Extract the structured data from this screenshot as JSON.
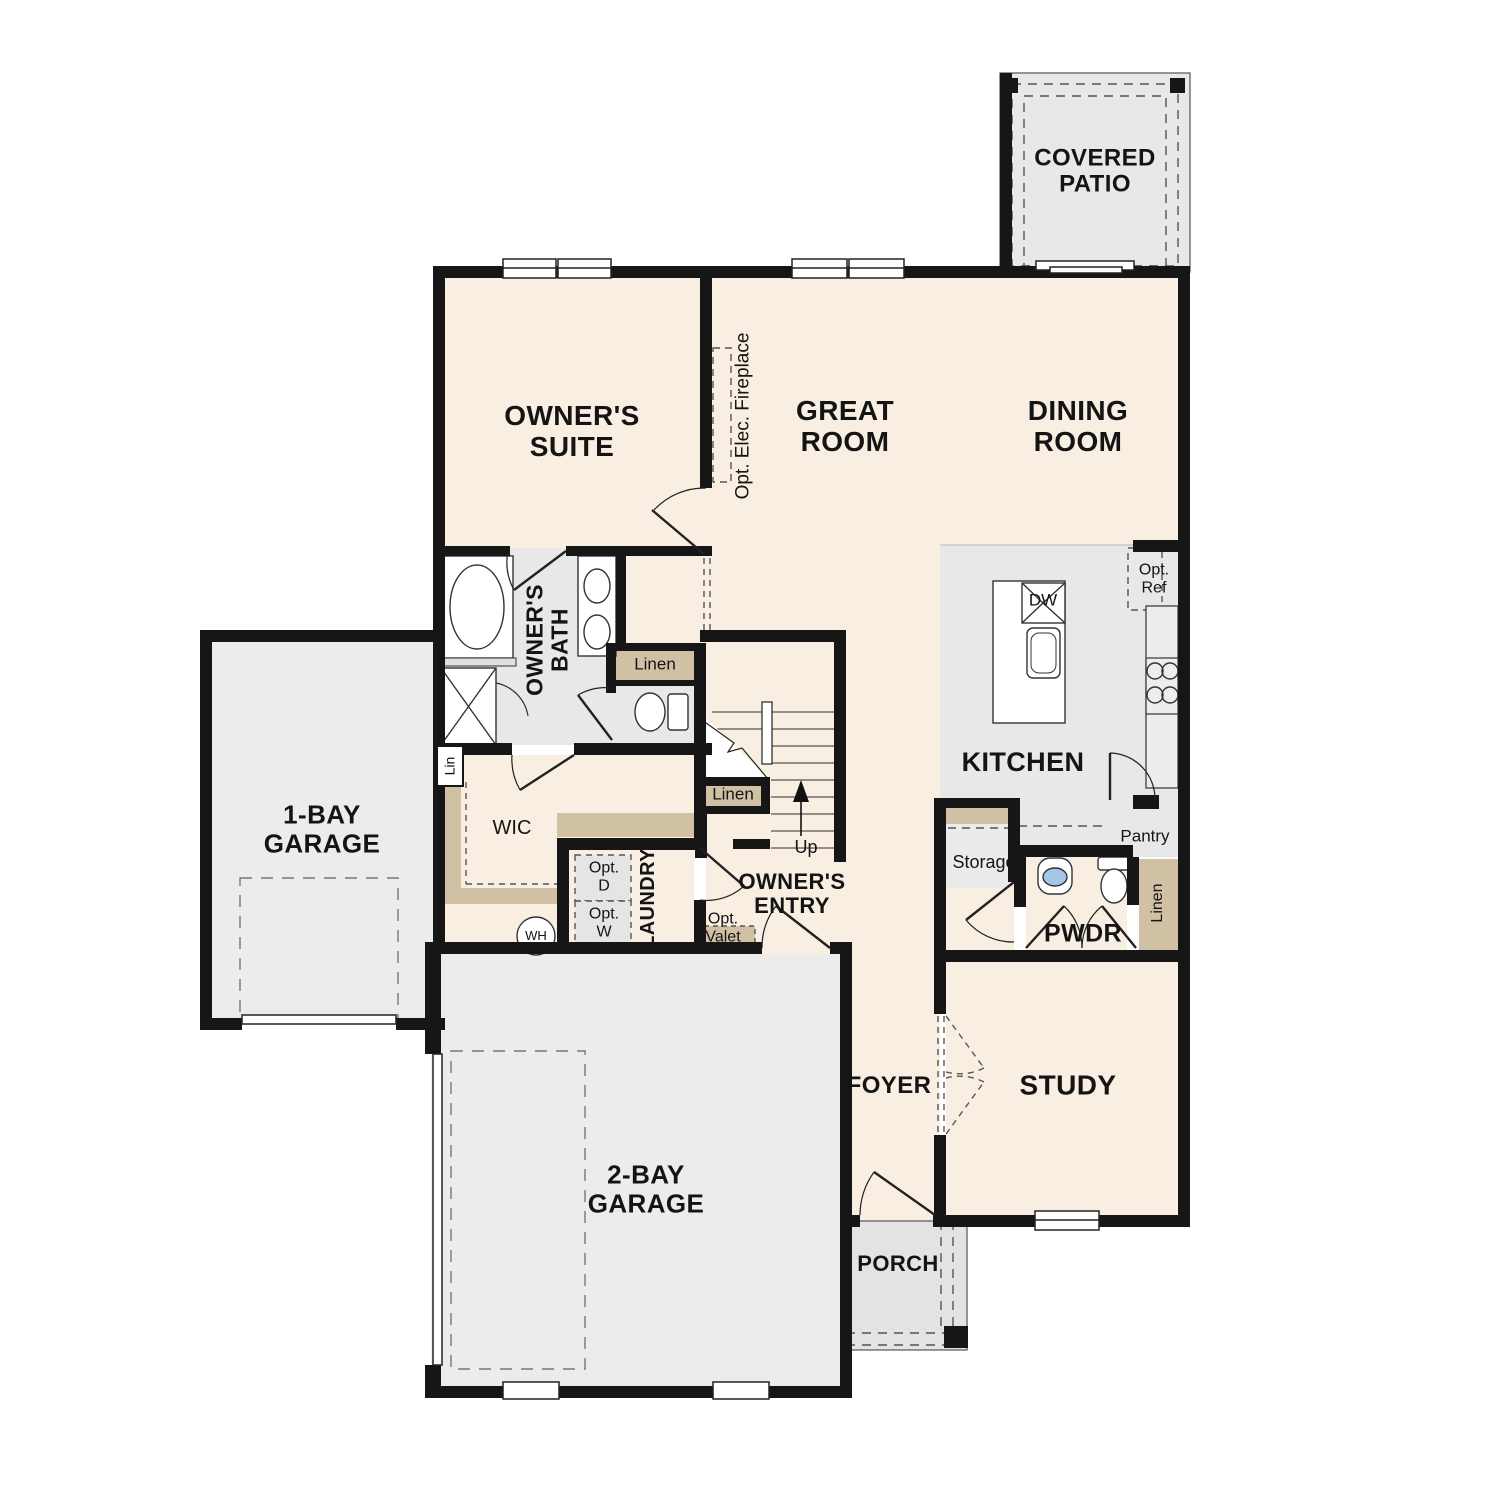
{
  "plan_title": "First floor plan",
  "colors": {
    "room_cream": "#f8eee2",
    "wet_area_gray": "#e8e8e8",
    "garage_gray": "#ececec",
    "porch_gray": "#e3e3e3",
    "shelf_tan": "#d0c1a4",
    "wall_black": "#161616",
    "sink_blue": "#a3c6e6",
    "appliance_box_gray": "#e4e6e4"
  },
  "rooms": {
    "covered_patio": "COVERED\nPATIO",
    "owners_suite": "OWNER'S\nSUITE",
    "great_room": "GREAT\nROOM",
    "dining_room": "DINING\nROOM",
    "kitchen": "KITCHEN",
    "owners_bath": "OWNER'S\nBATH",
    "wic": "WIC",
    "laundry": "LAUNDRY",
    "owners_entry": "OWNER'S\nENTRY",
    "one_bay_garage": "1-BAY\nGARAGE",
    "two_bay_garage": "2-BAY\nGARAGE",
    "foyer": "FOYER",
    "study": "STUDY",
    "pwdr": "PWDR",
    "storage": "Storage",
    "pantry": "Pantry",
    "porch": "PORCH"
  },
  "annotations": {
    "opt_elec_fireplace": "Opt. Elec. Fireplace",
    "linen_bath": "Linen",
    "linen_stairs": "Linen",
    "linen_pwdr": "Linen",
    "lin": "Lin",
    "up": "Up",
    "dw": "DW",
    "opt_ref": "Opt.\nRef",
    "opt_d": "Opt.\nD",
    "opt_w": "Opt.\nW",
    "wh": "WH",
    "opt_valet": "Opt.\nValet"
  }
}
